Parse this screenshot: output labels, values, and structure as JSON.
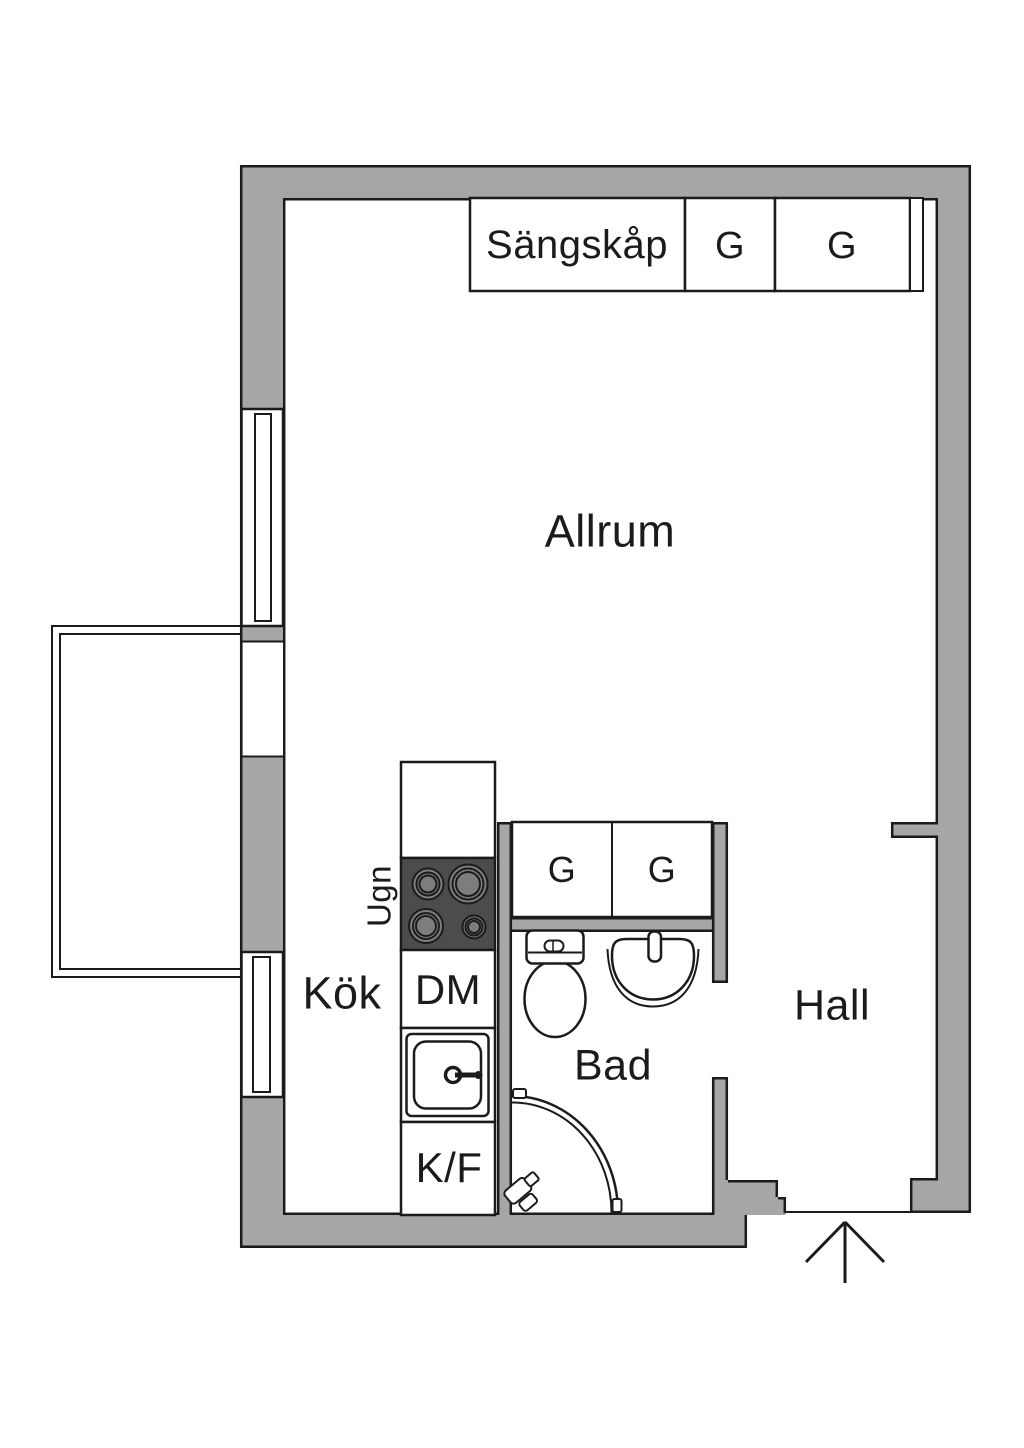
{
  "plan": {
    "colors": {
      "wall": "#a6a6a6",
      "stove": "#4c4c4f",
      "burner": "#7d7d80",
      "line": "#1b1b1b"
    },
    "labels": {
      "living_room": "Allrum",
      "kitchen": "Kök",
      "bathroom": "Bad",
      "hall": "Hall",
      "bed_cabinet": "Sängskåp",
      "wardrobe_top_1": "G",
      "wardrobe_top_2": "G",
      "wardrobe_mid_1": "G",
      "wardrobe_mid_2": "G",
      "oven": "Ugn",
      "dishwasher": "DM",
      "fridge_freezer": "K/F"
    }
  }
}
